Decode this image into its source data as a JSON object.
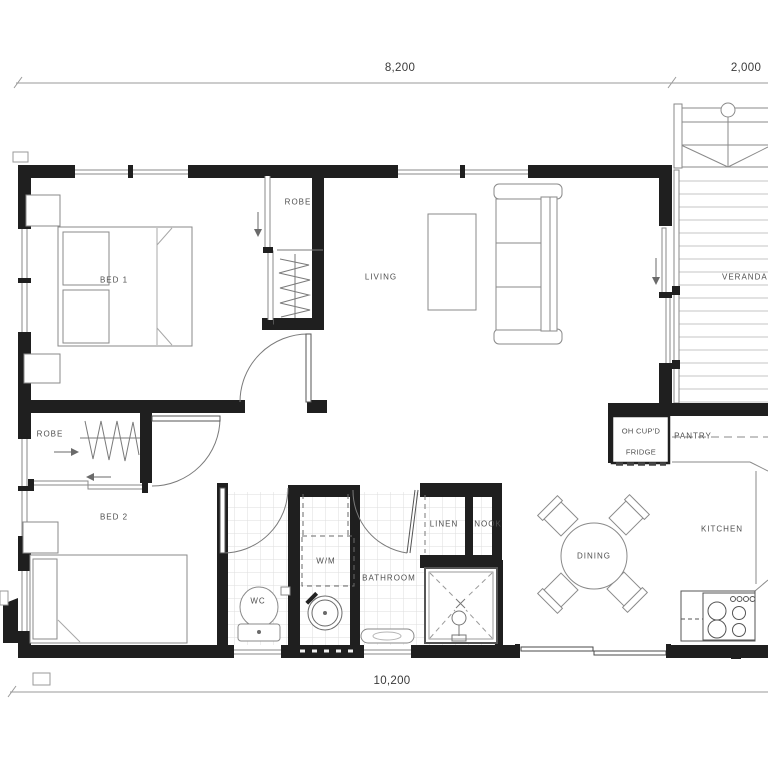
{
  "plan": {
    "dimensions": {
      "top_main": "8,200",
      "top_veranda": "2,000",
      "bottom_total": "10,200"
    },
    "rooms": {
      "bed1": "BED 1",
      "robe1": "ROBE",
      "living": "LIVING",
      "verandah": "VERANDAH",
      "robe2": "ROBE",
      "bed2": "BED 2",
      "wc": "WC",
      "washing_machine": "W/M",
      "bathroom": "BATHROOM",
      "linen": "LINEN",
      "nook": "NOOK",
      "dining": "DINING",
      "kitchen": "KITCHEN",
      "pantry": "PANTRY",
      "overhead_cupboard": "OH CUP'D",
      "fridge": "FRIDGE"
    },
    "icons": {
      "robe1_slider": "arrow-down",
      "living_slider": "arrow-down",
      "robe2_slider_right": "arrow-right",
      "robe2_slider_left": "arrow-left"
    },
    "colors": {
      "wall": "#1f1f1f",
      "line": "#8a8a8a",
      "line_light": "#c4c4c4",
      "tile": "#dddddd",
      "label": "#4f4f4f",
      "background": "#ffffff"
    }
  }
}
